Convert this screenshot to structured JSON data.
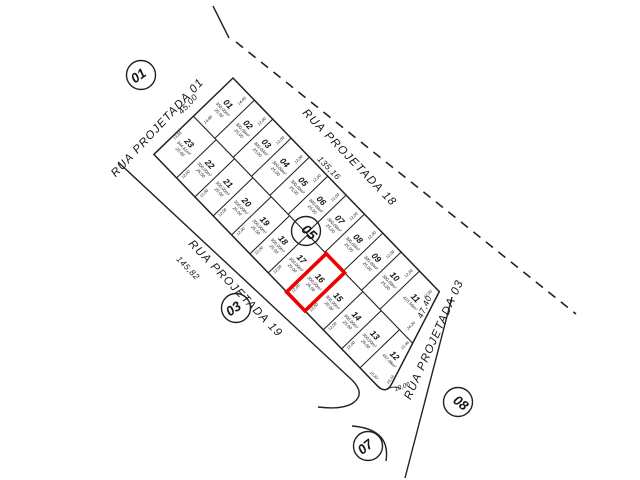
{
  "plan": {
    "background": "#ffffff",
    "line_color": "#222222",
    "text_color": "#151515",
    "highlight": {
      "lot": "16",
      "color": "#ee0000"
    },
    "quadra_badges": [
      {
        "label": "01"
      },
      {
        "label": "03"
      },
      {
        "label": "05"
      },
      {
        "label": "07"
      },
      {
        "label": "08"
      }
    ],
    "streets": [
      {
        "name": "RUA PROJETADA 01",
        "measure": "45,00"
      },
      {
        "name": "RUA PROJETADA 18",
        "measure": "135,16"
      },
      {
        "name": "RUA PROJETADA 19",
        "measure": "145,82"
      },
      {
        "name": "RUA PROJETADA 03",
        "measure": "47,40"
      }
    ],
    "corner_radius": "10,06",
    "lots_row_a": [
      {
        "number": "01",
        "area": "350,00m²",
        "depth": "25,00",
        "front": "14,00"
      },
      {
        "number": "02",
        "area": "300,00m²",
        "depth": "25,00",
        "front": "12,00"
      },
      {
        "number": "03",
        "area": "300,00m²",
        "depth": "25,00",
        "front": "12,00"
      },
      {
        "number": "04",
        "area": "300,00m²",
        "depth": "25,00",
        "front": "12,00"
      },
      {
        "number": "05",
        "area": "300,00m²",
        "depth": "25,00",
        "front": "12,00"
      },
      {
        "number": "06",
        "area": "300,00m²",
        "depth": "25,00",
        "front": "12,00"
      },
      {
        "number": "07",
        "area": "300,00m²",
        "depth": "25,00",
        "front": "12,00"
      },
      {
        "number": "08",
        "area": "300,00m²",
        "depth": "25,00",
        "front": "12,00"
      },
      {
        "number": "09",
        "area": "300,00m²",
        "depth": "25,00",
        "front": "12,00"
      },
      {
        "number": "10",
        "area": "300,00m²",
        "depth": "25,00",
        "front": "12,00"
      },
      {
        "number": "11",
        "area": "415,56m²",
        "depth": "",
        "front": "12,50"
      }
    ],
    "lots_row_b": [
      {
        "number": "23",
        "area": "344,61m²",
        "depth": "25,00",
        "front": "14,88"
      },
      {
        "number": "22",
        "area": "300,00m²",
        "depth": "25,00",
        "front": "12,00"
      },
      {
        "number": "21",
        "area": "300,00m²",
        "depth": "25,00",
        "front": "12,00"
      },
      {
        "number": "20",
        "area": "300,00m²",
        "depth": "25,00",
        "front": "12,00"
      },
      {
        "number": "19",
        "area": "300,00m²",
        "depth": "25,00",
        "front": "12,00"
      },
      {
        "number": "18",
        "area": "300,00m²",
        "depth": "25,00",
        "front": "12,00"
      },
      {
        "number": "17",
        "area": "300,00m²",
        "depth": "25,00",
        "front": "12,00"
      },
      {
        "number": "16",
        "area": "300,00m²",
        "depth": "25,00",
        "front": "12,00"
      },
      {
        "number": "15",
        "area": "300,00m²",
        "depth": "25,00",
        "front": "12,00"
      },
      {
        "number": "14",
        "area": "300,00m²",
        "depth": "25,00",
        "front": "12,00"
      },
      {
        "number": "13",
        "area": "300,00m²",
        "depth": "25,00",
        "front": "12,00"
      },
      {
        "number": "12",
        "area": "457,06m²",
        "depth": "",
        "front": "16,87",
        "side": "19,16"
      }
    ],
    "extra_dims": [
      {
        "text": "24,26"
      },
      {
        "text": "12,96"
      },
      {
        "text": "13,85"
      }
    ]
  }
}
